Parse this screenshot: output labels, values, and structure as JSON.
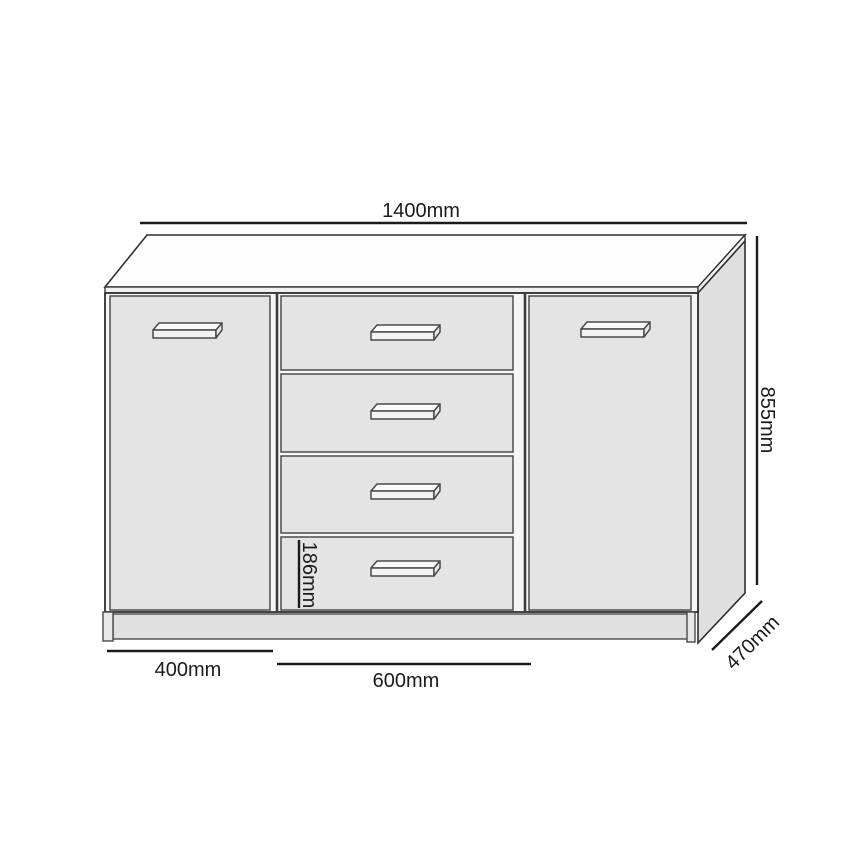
{
  "drawing": {
    "labels": {
      "overall_width": "1400mm",
      "overall_height": "855mm",
      "depth": "470mm",
      "door_width": "400mm",
      "drawer_section_width": "600mm",
      "drawer_front_height": "186mm"
    },
    "colors": {
      "background": "#ffffff",
      "line": "#1b1b1b",
      "outline": "#2f2f2f",
      "top_fill": "#fdfdfd",
      "strip_fill": "#f1f1f1",
      "side_fill": "#dfdfdf",
      "carcass_fill": "#f6f6f6",
      "panel_fill": "#e4e4e4",
      "plinth_fill": "#e0e0e0",
      "handle_fill": "#fafafa"
    }
  }
}
